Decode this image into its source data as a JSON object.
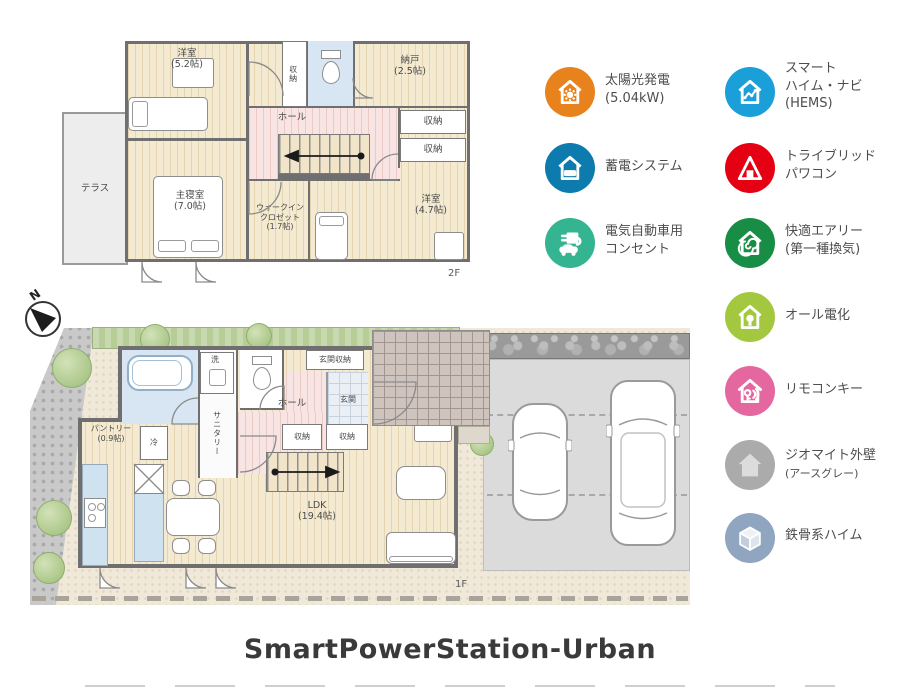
{
  "title": "SmartPowerStation-Urban",
  "compass": {
    "north": "N"
  },
  "floor2": {
    "label": "2F",
    "terrace": "テラス",
    "bedroom52_name": "洋室",
    "bedroom52_size": "(5.2帖)",
    "closet_top": "収納",
    "storeroom_name": "納戸",
    "storeroom_size": "(2.5帖)",
    "hall": "ホール",
    "closet_right1": "収納",
    "closet_right2": "収納",
    "master_name": "主寝室",
    "master_size": "(7.0帖)",
    "wic_line1": "ウォークイン",
    "wic_line2": "クロゼット",
    "wic_line3": "(1.7帖)",
    "bedroom47_name": "洋室",
    "bedroom47_size": "(4.7帖)"
  },
  "floor1": {
    "label": "1F",
    "laundry": "洗",
    "sanitary": "サニタリー",
    "hall": "ホール",
    "entrance_storage": "玄関収納",
    "entrance": "玄関",
    "closet1": "収納",
    "closet2": "収納",
    "pantry_name": "パントリー",
    "pantry_size": "(0.9帖)",
    "fridge": "冷",
    "ldk_name": "LDK",
    "ldk_size": "(19.4帖)"
  },
  "features": [
    {
      "icon": "solar-house-icon",
      "color": "#e8821c",
      "line1": "太陽光発電",
      "line2": "(5.04kW)"
    },
    {
      "icon": "hems-graph-house-icon",
      "color": "#1a9fd9",
      "line1": "スマート",
      "line2": "ハイム・ナビ",
      "line3": "(HEMS)"
    },
    {
      "icon": "battery-house-icon",
      "color": "#0e7bae",
      "line1": "蓄電システム"
    },
    {
      "icon": "power-conditioner-icon",
      "color": "#e60014",
      "line1": "トライブリッド",
      "line2": "パワコン"
    },
    {
      "icon": "ev-plug-car-icon",
      "color": "#35b491",
      "line1": "電気自動車用",
      "line2": "コンセント"
    },
    {
      "icon": "ventilation-house-icon",
      "color": "#188d45",
      "line1": "快適エアリー",
      "line2": "(第一種換気)"
    },
    {
      "icon": "all-electric-bulb-house-icon",
      "color": "#a3c840",
      "line1": "オール電化"
    },
    {
      "icon": "remote-key-house-icon",
      "color": "#e5679f",
      "line1": "リモコンキー"
    },
    {
      "icon": "exterior-wall-house-icon",
      "color": "#ababab",
      "line1": "ジオマイト外壁",
      "line2": "(アースグレー)"
    },
    {
      "icon": "steel-frame-cube-icon",
      "color": "#90a5bf",
      "line1": "鉄骨系ハイム"
    }
  ]
}
